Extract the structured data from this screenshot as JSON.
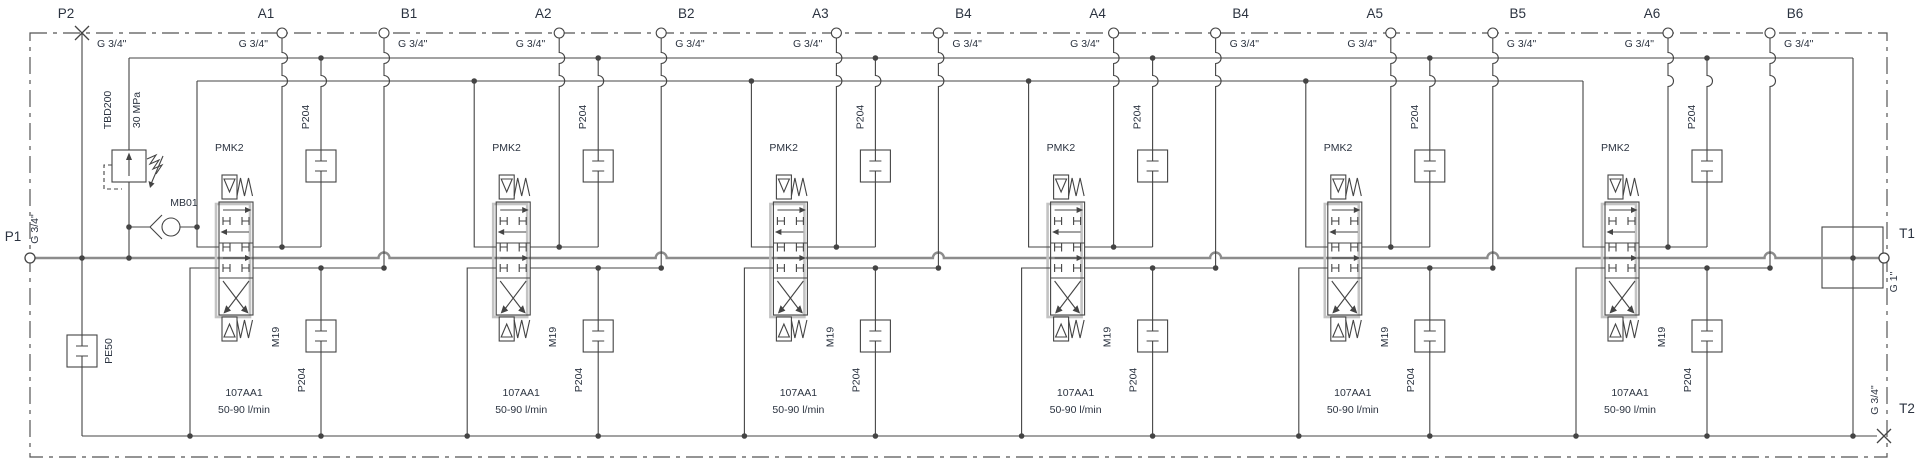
{
  "boundary_ports": {
    "p2": {
      "label": "P2",
      "size": "G 3/4\""
    },
    "p1": {
      "label": "P1",
      "size": "G 3/4\""
    },
    "t1": {
      "label": "T1",
      "size": "G 1\""
    },
    "t2": {
      "label": "T2",
      "size": "G 3/4\""
    }
  },
  "components": {
    "relief_valve": {
      "label": "TBD200",
      "setting": "30 MPa"
    },
    "check_valve": {
      "label": "MB01"
    },
    "plug": {
      "label": "PE50"
    }
  },
  "section_common": {
    "valve_label": "PMK2",
    "port_size": "G 3/4\"",
    "cartridge_top": "P204",
    "cartridge_bottom": "P204",
    "orifice": "M19",
    "spool_code": "107AA1",
    "flow_range": "50-90 l/min"
  },
  "sections": [
    {
      "a_port": "A1",
      "b_port": "B1"
    },
    {
      "a_port": "A2",
      "b_port": "B2"
    },
    {
      "a_port": "A3",
      "b_port": "B4"
    },
    {
      "a_port": "A4",
      "b_port": "B4"
    },
    {
      "a_port": "A5",
      "b_port": "B5"
    },
    {
      "a_port": "A6",
      "b_port": "B6"
    }
  ]
}
